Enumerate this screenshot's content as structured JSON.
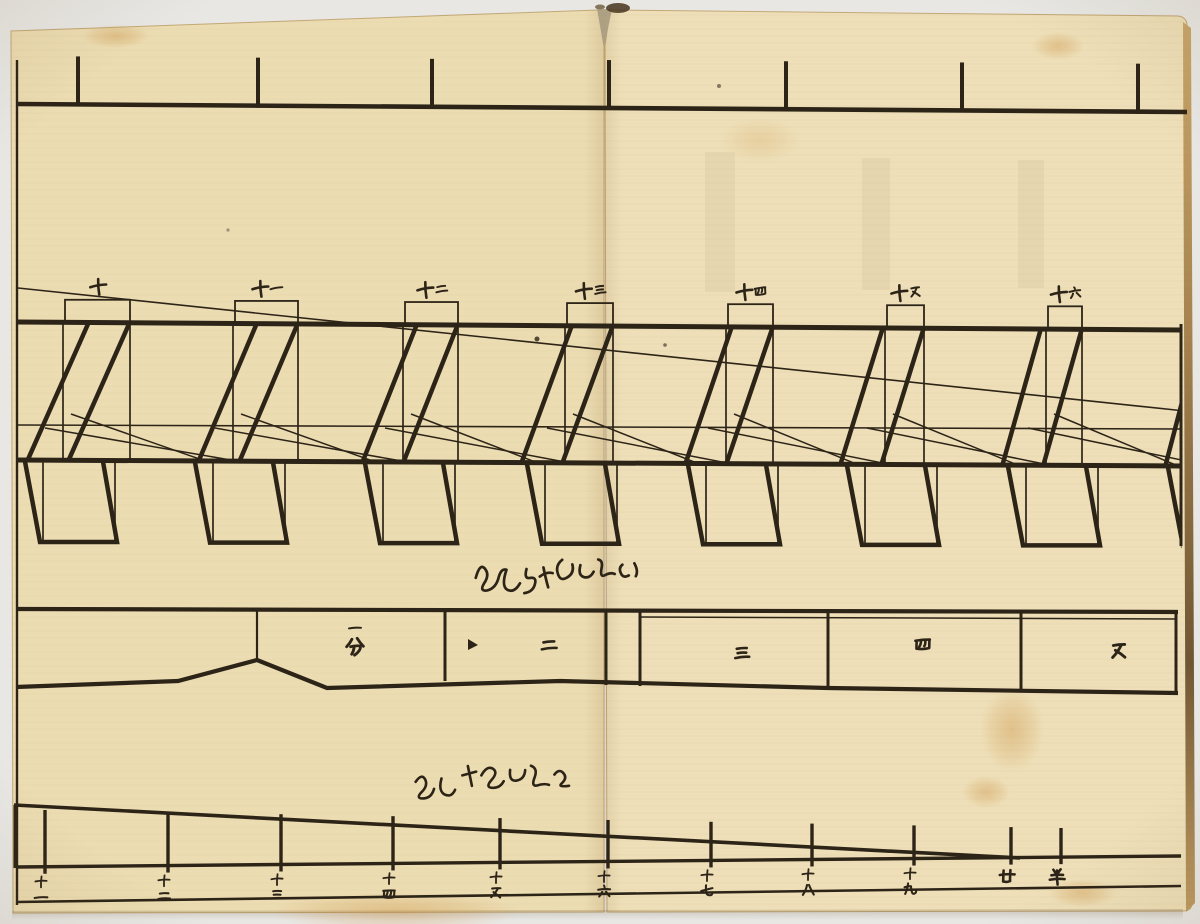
{
  "colors": {
    "bg": "#efeeeb",
    "paper_left": "#ecdcb2",
    "paper_right": "#eedfb8",
    "ink": "#2d2418",
    "page_edge": "#c3a876",
    "fore_edge_light": "#c9a76b",
    "fore_edge_dark": "#7e6137",
    "stain": "#c98f3f",
    "gap_shadow": "#b3a88e"
  },
  "top_ruler": {
    "line": {
      "x1": 18,
      "y1": 104,
      "x2": 1187,
      "y2": 112
    },
    "tick_length": 48,
    "ticks_x": [
      78,
      258,
      432,
      609,
      786,
      962,
      1138
    ]
  },
  "teeth_diagram": {
    "left_border": {
      "x": 17,
      "y1": 60,
      "y2": 905
    },
    "right_border": {
      "x": 1181,
      "y1": 324,
      "y2": 546
    },
    "top_line": {
      "x1": 18,
      "y1": 322,
      "x2": 1181,
      "y2": 330
    },
    "bottom_line": {
      "x1": 18,
      "y1": 460,
      "x2": 1181,
      "y2": 466
    },
    "thin_line": {
      "x1": 18,
      "y1": 425,
      "x2": 1181,
      "y2": 429
    },
    "long_diagonal": {
      "x1": 18,
      "y1": 288,
      "x2": 1185,
      "y2": 411
    },
    "box_height": 23,
    "foot": {
      "top_dx_left": -40,
      "top_dx_right": 38,
      "bot_dx_left": -25,
      "bot_dx_right": 52,
      "thin_dx_left": -22,
      "thin_dx_right": 50,
      "bottom_y_first": 542,
      "bottom_y_last": 546
    },
    "modules": [
      {
        "x": 65,
        "w": 65,
        "slant": 62,
        "label": "十"
      },
      {
        "x": 235,
        "w": 63,
        "slant": 59,
        "label": "十一"
      },
      {
        "x": 405,
        "w": 53,
        "slant": 55,
        "label": "十二"
      },
      {
        "x": 567,
        "w": 46,
        "slant": 51,
        "label": "十三"
      },
      {
        "x": 728,
        "w": 45,
        "slant": 47,
        "label": "十四"
      },
      {
        "x": 887,
        "w": 37,
        "slant": 43,
        "label": "十五"
      },
      {
        "x": 1048,
        "w": 34,
        "slant": 39,
        "label": "十六"
      },
      {
        "x": 1208,
        "w": 34,
        "slant": 36,
        "label": ""
      }
    ],
    "annotation_path": "M5,22 q5,-16 10,-8 q4,6 -2,14 q-5,8 3,7 q9,-2 12,-13 q3,-9 8,-7 q-6,16 0,20 q7,4 13,-6 m7,-14 q-3,10 3,9 q7,-1 5,6 q-2,8 -11,9 m20,-25 q2,12 4,20 m-8,-11 q7,-5 13,-3 m10,-13 q-7,5 -5,13 q2,9 9,5 q8,-4 6,-13 m8,1 q-3,10 3,12 q6,2 10,-5 m5,-12 q5,1 3,9 q-2,9 3,7 q6,-3 10,-1 m8,-9 q-4,3 -2,8 q2,6 8,3 m6,-12 q4,8 1,13",
    "annotation_pos": {
      "x": 470,
      "y": 556
    }
  },
  "scale_band": {
    "top_line": {
      "x1": 18,
      "y1": 609,
      "x2": 1178,
      "y2": 612
    },
    "bottom_polyline": [
      [
        16,
        687
      ],
      [
        178,
        681
      ],
      [
        257,
        660
      ],
      [
        327,
        688
      ],
      [
        560,
        681
      ],
      [
        828,
        688
      ],
      [
        1178,
        693
      ]
    ],
    "tent_vertical": {
      "x": 257,
      "y1": 609,
      "y2": 660
    },
    "dividers": [
      {
        "x": 445,
        "y1": 609,
        "y2": 681
      },
      {
        "x": 606,
        "y1": 609,
        "y2": 685
      },
      {
        "x": 640,
        "y1": 610,
        "y2": 686
      },
      {
        "x": 828,
        "y1": 612,
        "y2": 689
      },
      {
        "x": 1021,
        "y1": 613,
        "y2": 690
      },
      {
        "x": 1176,
        "y1": 613,
        "y2": 692
      }
    ],
    "inner_top_line": {
      "x1": 640,
      "y1": 617,
      "x2": 1176,
      "y2": 619
    },
    "cells": [
      {
        "label": "一分",
        "x": 355,
        "y": 620,
        "stacked": true,
        "sizes": [
          15,
          22
        ]
      },
      {
        "label": "二",
        "x": 548,
        "y": 645,
        "size": 20
      },
      {
        "label": "三",
        "x": 741,
        "y": 653,
        "size": 20
      },
      {
        "label": "四",
        "x": 922,
        "y": 644,
        "size": 20
      },
      {
        "label": "五",
        "x": 1118,
        "y": 651,
        "size": 22
      }
    ],
    "marker": {
      "points": "468,639 468,650 478,645"
    }
  },
  "bottom_ruler": {
    "diagonal": {
      "x1": 14,
      "y1": 805,
      "x2": 1020,
      "y2": 858
    },
    "baseline": {
      "x1": 16,
      "y1": 867,
      "x2": 1181,
      "y2": 856
    },
    "bottom_line": {
      "x1": 16,
      "y1": 902,
      "x2": 1181,
      "y2": 886
    },
    "left_cap": {
      "x": 15,
      "y1": 805,
      "y2": 868
    },
    "ticks": [
      {
        "x": 45,
        "label": "十一"
      },
      {
        "x": 168,
        "label": "十二"
      },
      {
        "x": 281,
        "label": "十三"
      },
      {
        "x": 393,
        "label": "十四"
      },
      {
        "x": 500,
        "label": "十五"
      },
      {
        "x": 608,
        "label": "十六"
      },
      {
        "x": 711,
        "label": "十七"
      },
      {
        "x": 812,
        "label": "十八"
      },
      {
        "x": 914,
        "label": "十九"
      },
      {
        "x": 1011,
        "label": "廿"
      },
      {
        "x": 1061,
        "label": "半"
      }
    ],
    "annotation_path": "M3,12 q7,-9 10,-1 q2,6 -5,12 q-6,6 2,6 q8,0 11,-9 m8,-10 q-4,12 2,16 q7,4 11,-4 m8,-14 l14,-3 m-8,-6 l3,20 m10,-10 q6,-10 12,-6 q5,4 -2,11 q-7,7 0,8 q8,1 12,-6 m7,-11 q-2,12 6,11 q8,-1 9,-10 m6,-4 q7,3 3,12 q-4,9 2,8 q7,-2 12,0 m6,-10 q5,-6 9,-1 q4,5 -2,10 q-5,4 7,3",
    "annotation_pos": {
      "x": 412,
      "y": 770
    }
  },
  "glyphs": {
    "一": [
      "M10,56 Q48,48 90,52"
    ],
    "二": [
      "M24,36 Q50,31 78,34",
      "M14,70 Q50,63 88,67"
    ],
    "三": [
      "M26,28 Q52,24 76,27",
      "M29,50 Q52,47 72,50",
      "M16,74 Q52,67 86,71"
    ],
    "四": [
      "M14,32 Q50,28 86,30",
      "M20,34 L17,72 Q50,79 81,72 L84,32",
      "M42,34 Q40,54 31,64",
      "M63,32 Q65,50 57,61"
    ],
    "五": [
      "M26,24 Q52,20 78,22",
      "M62,24 Q46,54 20,78",
      "M34,46 Q58,62 76,80"
    ],
    "六": [
      "M50,12 Q54,17 54,23",
      "M14,38 Q52,31 88,35",
      "M38,52 Q32,68 20,80",
      "M62,50 Q74,65 84,78"
    ],
    "七": [
      "M14,52 Q48,42 84,34",
      "M44,16 Q42,48 46,64 Q50,80 72,78 Q80,77 82,70"
    ],
    "八": [
      "M44,20 Q38,52 18,82",
      "M56,20 Q70,52 86,80"
    ],
    "九": [
      "M38,16 Q36,48 20,82",
      "M16,40 Q42,32 56,34 Q58,62 64,76 Q72,88 86,74 Q89,70 88,64"
    ],
    "十": [
      "M10,48 Q52,40 90,44",
      "M54,12 Q48,52 50,90"
    ],
    "廿": [
      "M33,20 Q31,50 31,74",
      "M67,18 Q65,48 65,72",
      "M14,42 Q50,35 88,39",
      "M31,74 Q50,80 65,72"
    ],
    "半": [
      "M32,18 Q38,26 41,32",
      "M68,16 Q61,24 58,30",
      "M22,46 Q52,41 80,44",
      "M14,68 Q52,61 88,65",
      "M50,22 Q48,56 53,92"
    ],
    "分": [
      "M36,18 Q26,38 12,52",
      "M60,14 Q74,36 88,50",
      "M30,52 Q62,45 72,49 Q78,54 70,68 Q61,82 48,90",
      "M46,54 Q44,72 35,86"
    ]
  }
}
